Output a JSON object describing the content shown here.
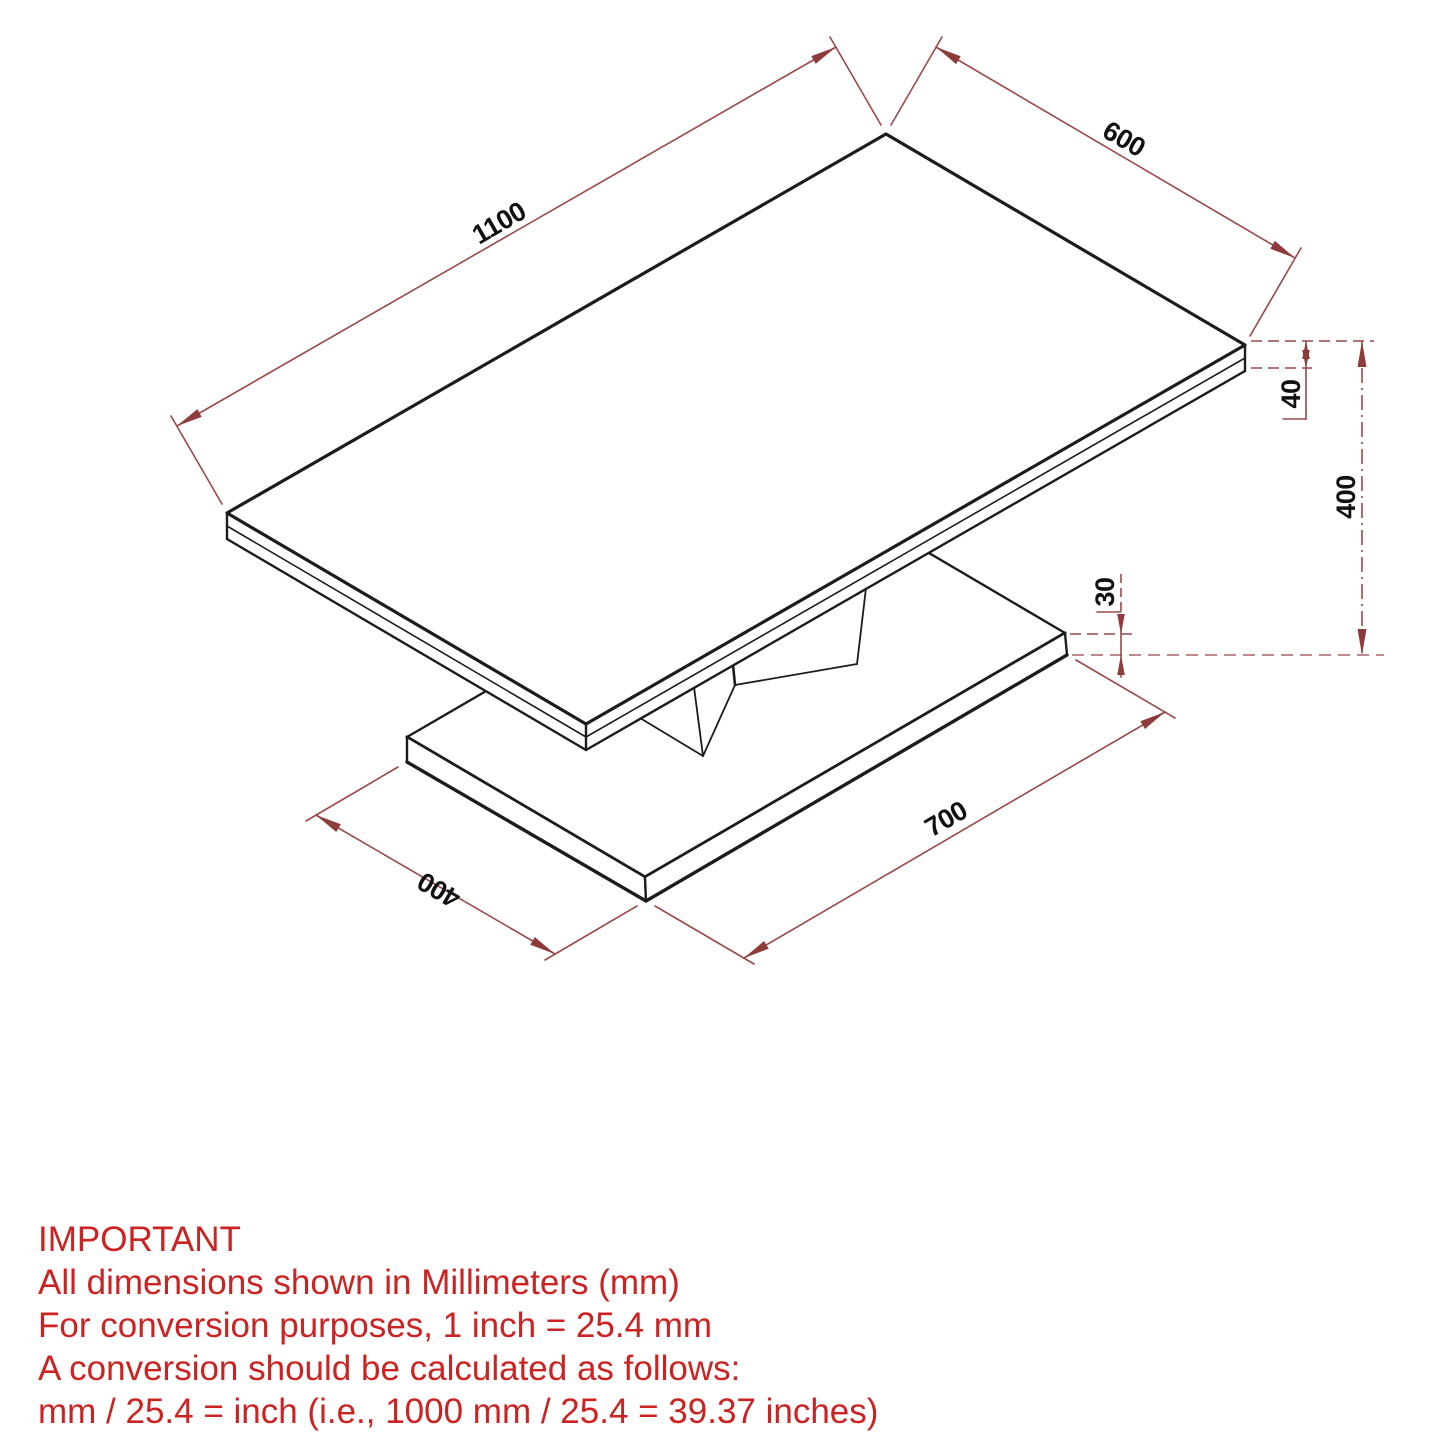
{
  "drawing": {
    "title": "coffee-table-isometric-dimension-drawing",
    "units": "mm",
    "dimensions": {
      "top_length": "1100",
      "top_depth": "600",
      "top_thickness": "40",
      "overall_height": "400",
      "base_thickness": "30",
      "base_length": "700",
      "base_depth": "400"
    },
    "dimensions_mm": {
      "top_length": 1100,
      "top_depth": 600,
      "top_thickness": 40,
      "overall_height": 400,
      "base_thickness": 30,
      "base_length": 700,
      "base_depth": 400
    },
    "colors": {
      "outline": "#1c1c1c",
      "dimension_line": "#9a4848",
      "dimension_text": "#111111",
      "note_text": "#cc2222",
      "background": "#ffffff"
    }
  },
  "notes": {
    "title": "IMPORTANT",
    "line1": "All dimensions shown in Millimeters (mm)",
    "line2": "For conversion purposes, 1 inch = 25.4 mm",
    "line3": "A conversion should be calculated as follows:",
    "line4": "mm / 25.4 = inch (i.e., 1000 mm / 25.4 = 39.37 inches)"
  }
}
